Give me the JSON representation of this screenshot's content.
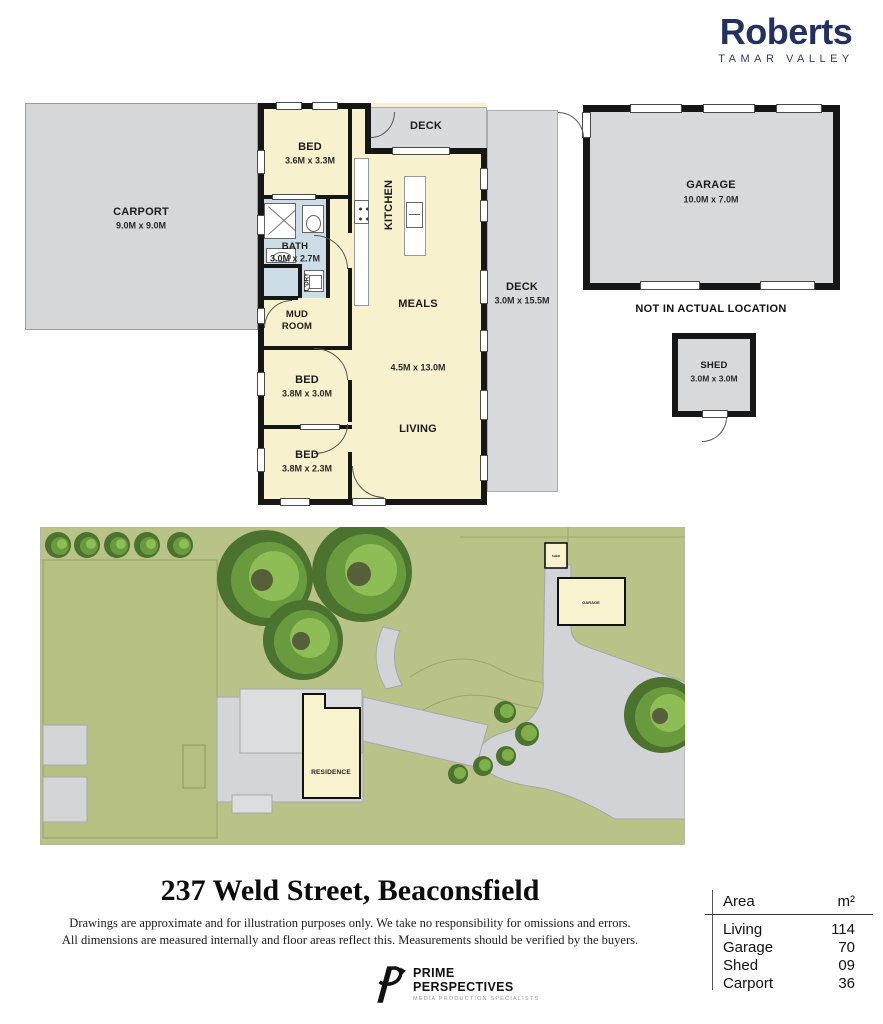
{
  "brand": {
    "name": "Roberts",
    "tagline": "TAMAR VALLEY"
  },
  "floorplan": {
    "carport": {
      "name": "CARPORT",
      "dims": "9.0M x 9.0M"
    },
    "bed1": {
      "name": "BED",
      "dims": "3.6M x 3.3M"
    },
    "deck_top": {
      "name": "DECK"
    },
    "kitchen": {
      "name": "KITCHEN"
    },
    "bath": {
      "name": "BATH",
      "dims": "3.0M x 2.7M"
    },
    "laundry": {
      "name": "L'DRY"
    },
    "mudroom": {
      "line1": "MUD",
      "line2": "ROOM"
    },
    "meals": {
      "name": "MEALS"
    },
    "living_dims": "4.5M x 13.0M",
    "living": {
      "name": "LIVING"
    },
    "bed2": {
      "name": "BED",
      "dims": "3.8M x 3.0M"
    },
    "bed3": {
      "name": "BED",
      "dims": "3.8M x 2.3M"
    },
    "deck_right": {
      "name": "DECK",
      "dims": "3.0M x 15.5M"
    },
    "garage": {
      "name": "GARAGE",
      "dims": "10.0M x 7.0M"
    },
    "garage_note": "NOT IN ACTUAL LOCATION",
    "shed": {
      "name": "SHED",
      "dims": "3.0M x 3.0M"
    }
  },
  "siteplan": {
    "residence": "RESIDENCE",
    "garage": "GARAGE",
    "shed": "SHED"
  },
  "footer": {
    "title": "237 Weld Street, Beaconsfield",
    "disclaimer1": "Drawings are approximate and for illustration purposes only. We take no responsibility for omissions and errors.",
    "disclaimer2": "All dimensions are measured internally and floor areas reflect this. Measurements should be verified by the buyers.",
    "producer_line1": "PRIME",
    "producer_line2": "PERSPECTIVES",
    "producer_tagline": "MEDIA PRODUCTION SPECIALISTS"
  },
  "area_table": {
    "headers": [
      "Area",
      "m²"
    ],
    "rows": [
      [
        "Living",
        "114"
      ],
      [
        "Garage",
        "70"
      ],
      [
        "Shed",
        "09"
      ],
      [
        "Carport",
        "36"
      ]
    ]
  },
  "colors": {
    "brand_navy": "#24315e",
    "room_cream": "#f7f1cd",
    "wet_blue": "#ccdde8",
    "deck_gray": "#d9dadd",
    "site_green": "#b9c287"
  }
}
